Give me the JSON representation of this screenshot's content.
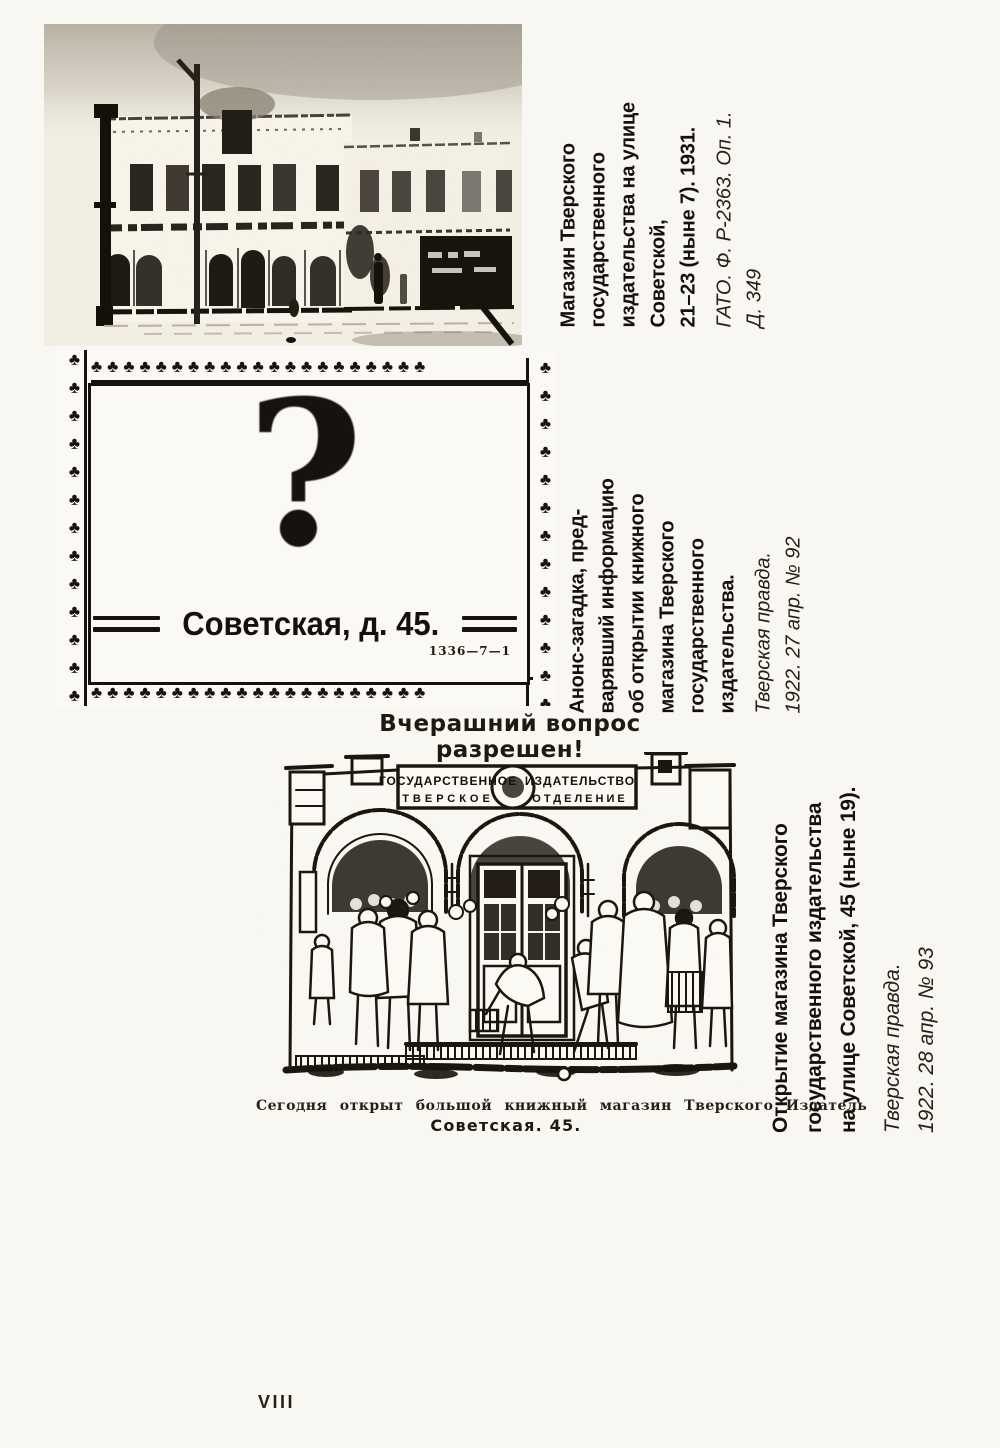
{
  "page": {
    "number": "VIII"
  },
  "colors": {
    "ink": "#1b1712",
    "paper": "#f9f7f1"
  },
  "figure1": {
    "caption": {
      "bold_lines": [
        "Магазин Тверского",
        "государственного",
        "издательства на улице",
        "Советской,",
        "21–23 (ныне 7). 1931."
      ],
      "italic_lines": [
        "ГАТО. Ф. Р-2363. Оп. 1.",
        "Д. 349"
      ]
    }
  },
  "figure2": {
    "border_glyph": "♣",
    "border_counts": {
      "top": 21,
      "bottom": 21,
      "left": 13,
      "right": 13
    },
    "question_mark": "?",
    "address": "Советская, д. 45.",
    "print_code": "1336—7—1",
    "caption": {
      "bold_lines": [
        "Анонс-загадка, пред-",
        "варявший информацию",
        "об открытии книжного",
        "магазина Тверского",
        "государственного",
        "издательства."
      ],
      "italic_lines": [
        "Тверская правда.",
        "1922. 27 апр. № 92"
      ]
    }
  },
  "figure3": {
    "headline": "Вчерашний вопрос разрешен!",
    "sign": {
      "line1_left": "ГОСУДАРСТВЕННОЕ",
      "line1_right": "ИЗДАТЕЛЬСТВО",
      "line2_left": "ТВЕРСКОЕ",
      "line2_right": "ОТДЕЛЕНИЕ"
    },
    "sub_caption_line1": "Сегодня открыт большой книжный магазин Тверского Издатель",
    "sub_caption_line2": "Советская. 45.",
    "caption": {
      "bold_lines": [
        "Открытие магазина Тверского",
        "государственного издательства",
        "на улице Советской, 45 (ныне 19)."
      ],
      "italic_lines": [
        "Тверская правда.",
        "1922. 28 апр. № 93"
      ]
    }
  }
}
